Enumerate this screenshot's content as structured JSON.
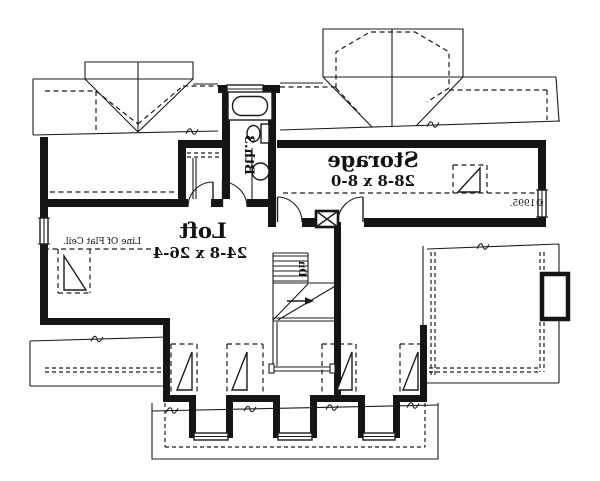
{
  "floor_plan": {
    "rooms": {
      "storage": {
        "label": "Storage",
        "dims": "28-8 x 8-0"
      },
      "loft": {
        "label": "Loft",
        "dims": "24-8 x 26-4"
      },
      "bath": {
        "label": "Bth.3"
      }
    },
    "stairs": {
      "down_label": "Dn"
    },
    "annotations": {
      "flat_ceiling": "Line Of Flat Ceil.",
      "copyright": "©1995."
    },
    "colors": {
      "ink": "#1c1c1c",
      "paper": "#ffffff"
    }
  }
}
